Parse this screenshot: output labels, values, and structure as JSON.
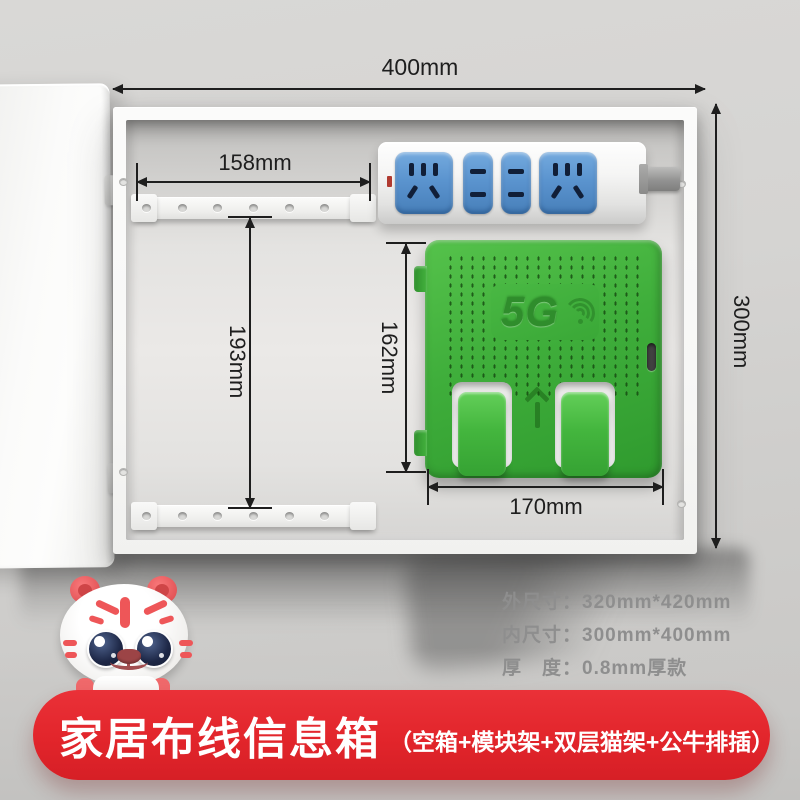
{
  "dimensions": {
    "top_width": "400mm",
    "right_height": "300mm",
    "rail_width": "158mm",
    "rail_gap": "193mm",
    "holder_height": "162mm",
    "holder_width": "170mm"
  },
  "router_holder": {
    "logo": "5G"
  },
  "specs": {
    "lines": [
      "外尺寸：320mm*420mm",
      "内尺寸：300mm*400mm",
      "厚　度：0.8mm厚款"
    ]
  },
  "banner": {
    "title": "家居布线信息箱",
    "subtitle": "（空箱+模块架+双层猫架+公牛排插）"
  },
  "colors": {
    "banner_red": "#e2252b",
    "holder_green": "#3fae3b",
    "socket_blue": "#5b94cf",
    "dimension_ink": "#1e1e1e",
    "spec_gray": "#8e8e8e"
  }
}
